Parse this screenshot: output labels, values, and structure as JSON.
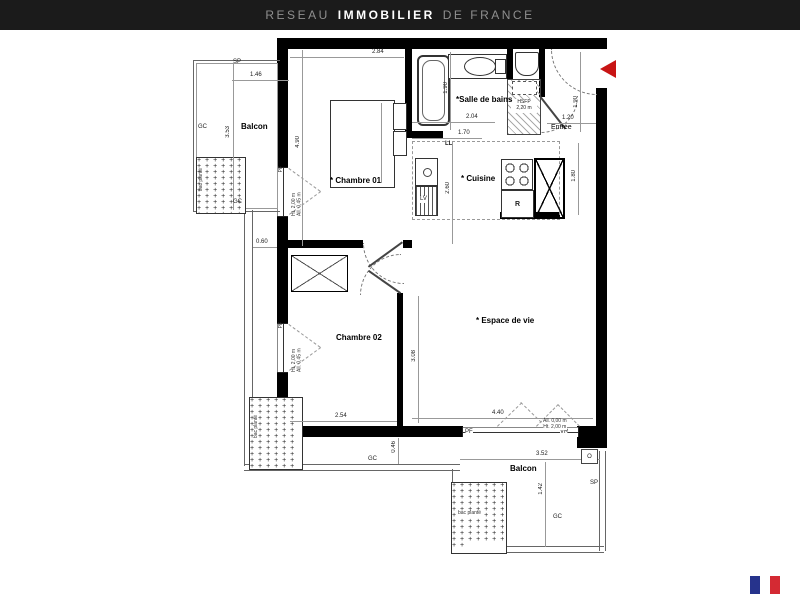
{
  "plan": {
    "rooms": {
      "balcony_left": "Balcon",
      "bedroom1": "* Chambre 01",
      "bathroom": "*Salle de bains",
      "entry": "Entrée",
      "kitchen": "* Cuisine",
      "bedroom2": "Chambre 02",
      "living": "* Espace de vie",
      "balcony_bottom": "Balcon"
    },
    "fixtures": {
      "fridge": "R",
      "washing_machine": "LL",
      "dishwasher": "LV",
      "light_fixture": "O"
    },
    "window_labels": {
      "pf": "PF",
      "vr": "VR"
    },
    "site_labels": {
      "gc": "GC",
      "sp": "SP",
      "planter": "bac planté"
    },
    "annotations": {
      "closet_line1": "HSFP",
      "closet_line2": "2,20 m",
      "window_height": "Ht. 2,00 m",
      "window_sill": "All. 0,45 m",
      "living_window_sill": "All. 0,00 m",
      "living_window_height": "Ht. 2,00 m"
    },
    "dimensions": {
      "bedroom1_width": "2.84",
      "bedroom1_depth": "4.90",
      "balcony_left_width": "1.46",
      "balcony_left_depth": "3.53",
      "balcony_offset": "0.60",
      "bathroom_width": "2.04",
      "bathroom_depth": "1.90",
      "kitchen_width": "1.70",
      "kitchen_depth": "2.60",
      "kitchen_side": "1.80",
      "entry_width": "1.20",
      "entry_depth": "1.90",
      "bedroom2_width": "2.54",
      "bedroom2_depth": "3.08",
      "living_width": "4.40",
      "balcony_bottom_width": "3.52",
      "balcony_bottom_depth": "1.42",
      "balcony_bottom_offset": "0.46"
    }
  },
  "footer": {
    "brand_1": "RESEAU",
    "brand_2": "IMMOBILIER",
    "brand_3": "DE FRANCE"
  },
  "colors": {
    "arrow_red": "#C81414",
    "footer_bg": "#1B1B1B",
    "flag_blue": "#26338C",
    "flag_red": "#D42A33"
  }
}
